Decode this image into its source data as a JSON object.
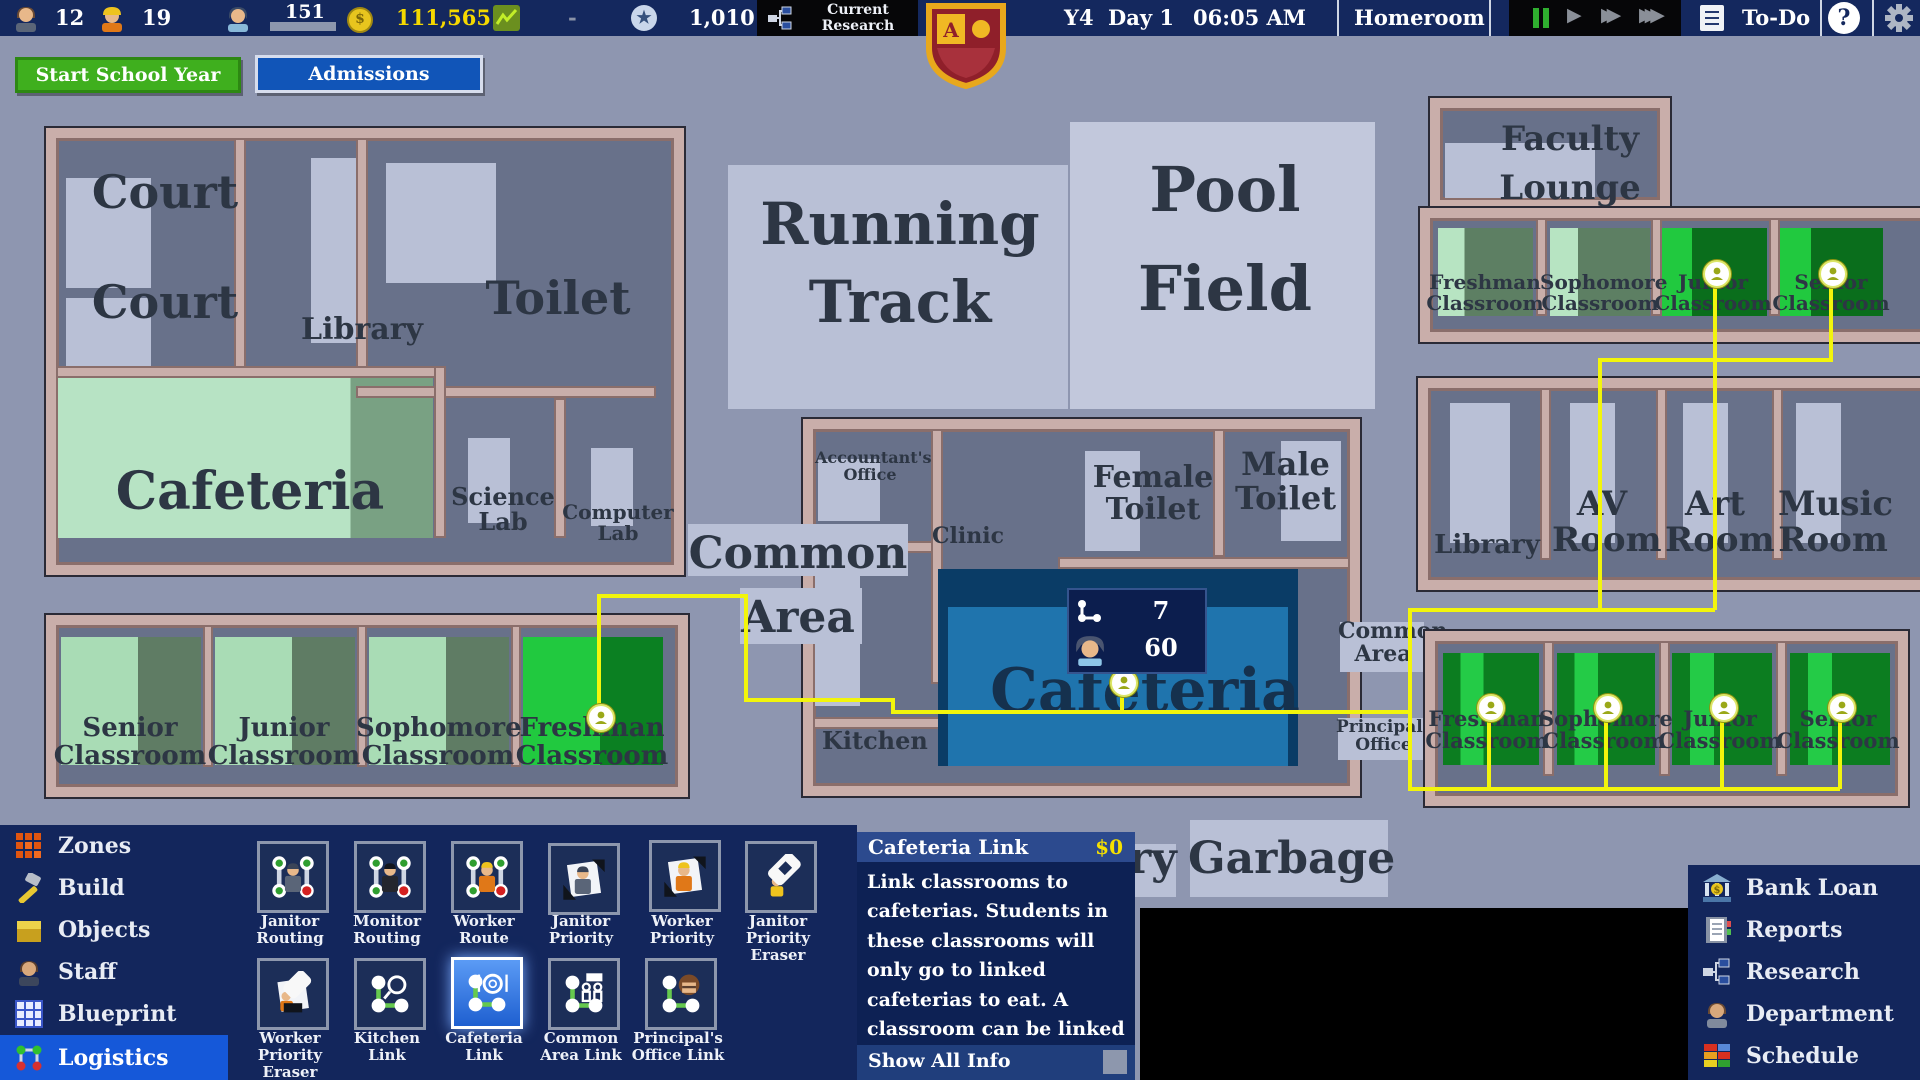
{
  "top_bar": {
    "teachers": "12",
    "workers": "19",
    "students": "151",
    "money": "111,565",
    "balance": "-",
    "prestige": "1,010",
    "research_line1": "Current",
    "research_line2": "Research",
    "year": "Y4",
    "day": "Day 1",
    "time": "06:05 AM",
    "period": "Homeroom",
    "todo": "To-Do",
    "help": "?"
  },
  "actions": {
    "start_school_year": "Start School Year",
    "admissions": "Admissions"
  },
  "rooms": {
    "court_a": "Court",
    "court_b": "Court",
    "library_w": "Library",
    "toilet": "Toilet",
    "cafeteria_w": "Cafeteria",
    "science_lab": "Science Lab",
    "computer_lab": "Computer Lab",
    "senior_sw": "Senior Classroom",
    "junior_sw": "Junior Classroom",
    "sophomore_sw": "Sophomore Classroom",
    "freshman_sw": "Freshman Classroom",
    "running_track": "Running Track",
    "pool_field": "Pool Field",
    "accountants_office": "Accountant's Office",
    "clinic": "Clinic",
    "common_area_c": "Common Area",
    "kitchen": "Kitchen",
    "cafeteria_c": "Cafeteria",
    "female_toilet": "Female Toilet",
    "male_toilet": "Male Toilet",
    "faculty_lounge": "Faculty Lounge",
    "freshman_ne": "Freshman Classroom",
    "sophomore_ne": "Sophomore Classroom",
    "junior_ne": "Junior Classroom",
    "senior_ne": "Senior Classroom",
    "library_e": "Library",
    "av_room": "AV Room",
    "art_room": "Art Room",
    "music_room": "Music Room",
    "common_area_e": "Common Area",
    "principals_office": "Principal's Office",
    "freshman_se": "Freshman Classroom",
    "sophomore_se": "Sophomore Classroom",
    "junior_se": "Junior Classroom",
    "senior_se": "Senior Classroom",
    "garbage": "Garbage",
    "laundry_partial": "ry"
  },
  "overlay": {
    "links": "7",
    "students": "60"
  },
  "left_menu": {
    "items": [
      "Zones",
      "Build",
      "Objects",
      "Staff",
      "Blueprint",
      "Logistics"
    ]
  },
  "toolbar": {
    "row1": [
      "Janitor Routing",
      "Monitor Routing",
      "Worker Route",
      "Janitor Priority",
      "Worker Priority",
      "Janitor Priority Eraser"
    ],
    "row2": [
      "Worker Priority Eraser",
      "Kitchen Link",
      "Cafeteria Link",
      "Common Area Link",
      "Principal's Office Link"
    ]
  },
  "tooltip": {
    "title": "Cafeteria Link",
    "cost": "$0",
    "body": "Link classrooms to cafeterias. Students in these classrooms will only go to linked cafeterias to eat. A classroom can be linked to multiple cafeterias.",
    "footer": "Show All Info"
  },
  "right_menu": {
    "items": [
      "Bank Loan",
      "Reports",
      "Research",
      "Department",
      "Schedule"
    ]
  },
  "colors": {
    "accent_blue": "#1558d9",
    "money_yellow": "#f5d800",
    "link_yellow": "#f2f50c",
    "start_green": "#3faf1e",
    "admissions_blue": "#1155b8"
  }
}
